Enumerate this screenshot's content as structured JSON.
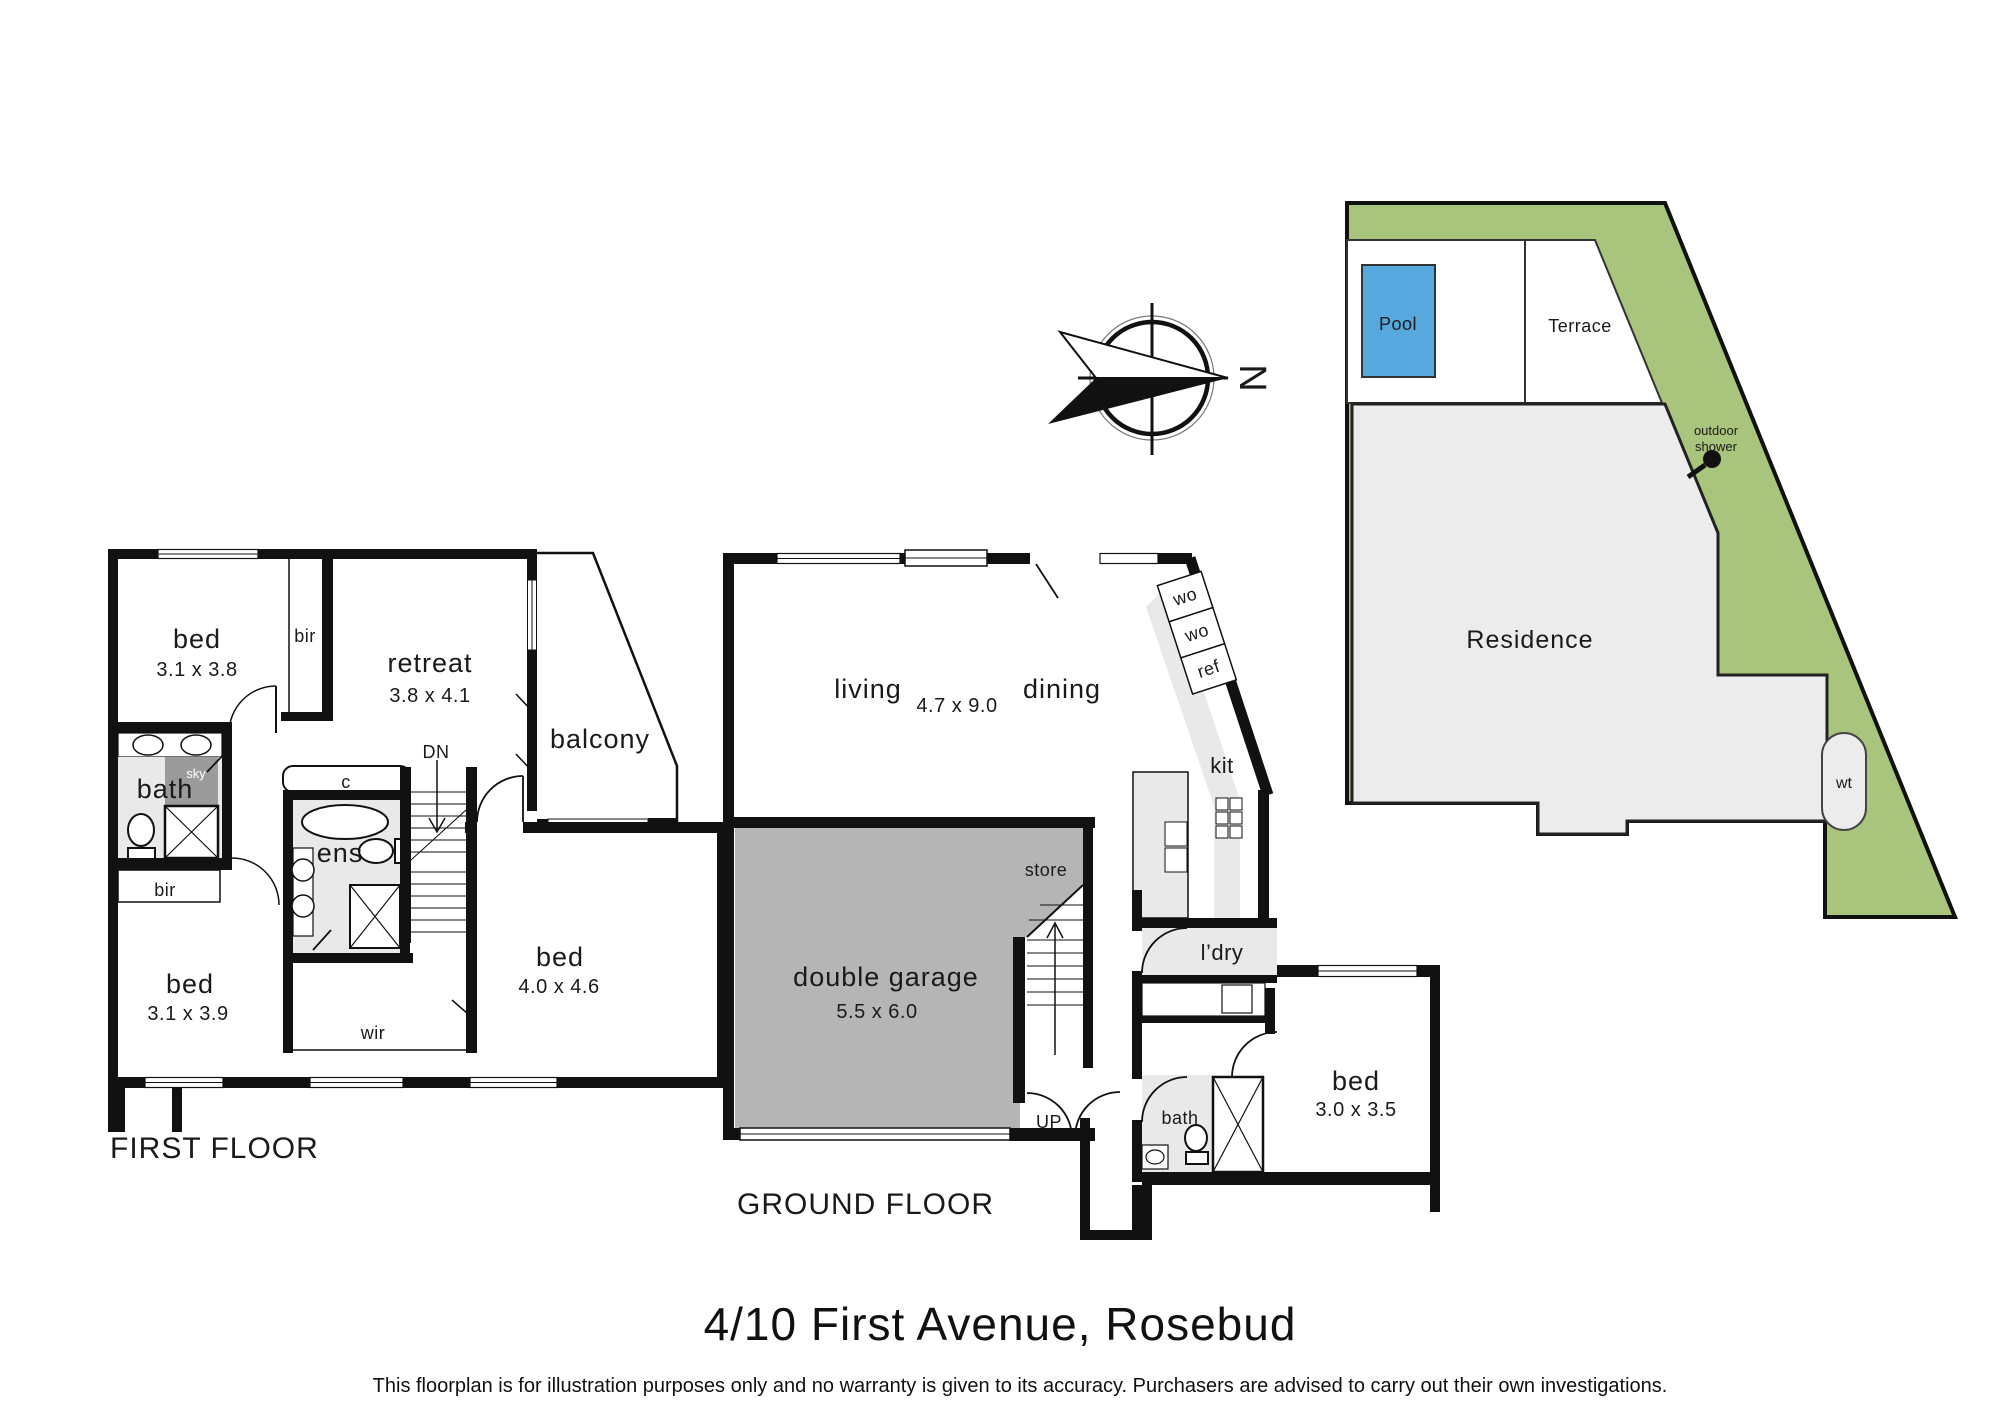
{
  "page": {
    "title": "4/10 First Avenue, Rosebud",
    "disclaimer": "This floorplan is for illustration purposes only and no warranty is given to its accuracy. Purchasers are advised to carry out their own investigations."
  },
  "compass": {
    "north": "N"
  },
  "first_floor": {
    "label": "FIRST FLOOR",
    "bed1": "bed",
    "bed1_dims": "3.1 x 3.8",
    "bir1": "bir",
    "retreat": "retreat",
    "retreat_dims": "3.8 x 4.1",
    "balcony": "balcony",
    "bath": "bath",
    "sky": "sky",
    "bir2": "bir",
    "bed2": "bed",
    "bed2_dims": "3.1 x 3.9",
    "ens": "ens",
    "closet": "c",
    "dn": "DN",
    "wir": "wir",
    "bed3": "bed",
    "bed3_dims": "4.0 x 4.6"
  },
  "ground_floor": {
    "label": "GROUND FLOOR",
    "living": "living",
    "living_dims": "4.7 x 9.0",
    "dining": "dining",
    "wo1": "wo",
    "wo2": "wo",
    "ref": "ref",
    "kit": "kit",
    "store": "store",
    "garage": "double garage",
    "garage_dims": "5.5 x 6.0",
    "up": "UP",
    "ldry": "l’dry",
    "bath": "bath",
    "bed": "bed",
    "bed_dims": "3.0 x 3.5"
  },
  "site": {
    "pool": "Pool",
    "terrace": "Terrace",
    "residence": "Residence",
    "outdoor_shower_line1": "outdoor",
    "outdoor_shower_line2": "shower",
    "water_tank": "wt"
  },
  "colors": {
    "green": "#a9c47c",
    "pool_blue": "#56a8de",
    "room_gray": "#e9e9e9",
    "residence_gray": "#ececec",
    "garage_gray": "#b5b5b5",
    "sky_gray": "#9b9b9b"
  }
}
